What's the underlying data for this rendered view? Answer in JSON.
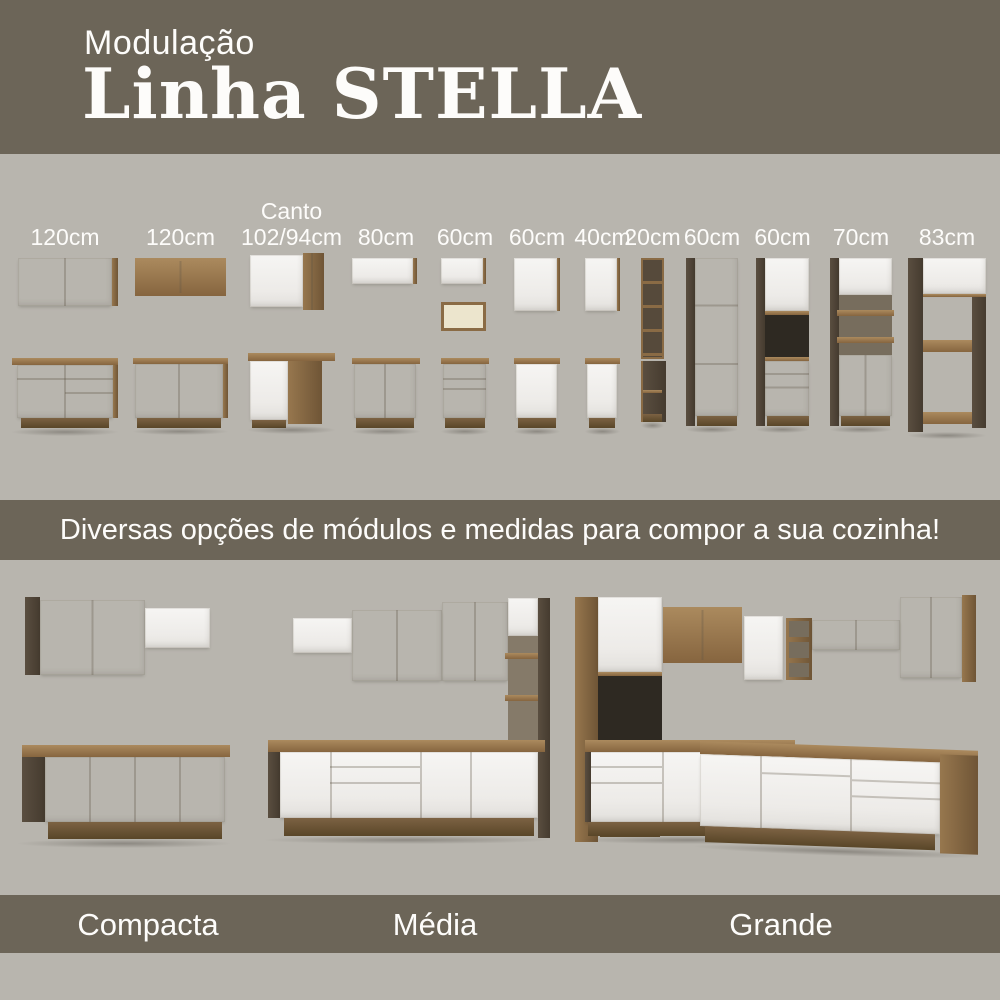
{
  "header": {
    "kicker": "Modulação",
    "title": "Linha STELLA"
  },
  "modules": {
    "items": [
      {
        "label": "120cm",
        "type": "wall-2door + base-drawers"
      },
      {
        "label": "120cm",
        "type": "wall-glass + base-2door"
      },
      {
        "label_top": "Canto",
        "label": "102/94cm",
        "type": "corner wall + corner base"
      },
      {
        "label": "80cm",
        "type": "wall-flap + base-2door"
      },
      {
        "label": "60cm",
        "type": "wall-flap + open-niche + base-drawers"
      },
      {
        "label": "60cm",
        "type": "wall-1door + base-1door"
      },
      {
        "label": "40cm",
        "type": "wall-1door + base-1door"
      },
      {
        "label": "20cm",
        "type": "open-shelf-rack + narrow-base"
      },
      {
        "label": "60cm",
        "type": "tall-pantry-3door"
      },
      {
        "label": "60cm",
        "type": "tall-oven-tower"
      },
      {
        "label": "70cm",
        "type": "tall-shelf-cabinet"
      },
      {
        "label": "83cm",
        "type": "tall-open-frame"
      }
    ]
  },
  "banner": {
    "text": "Diversas opções de módulos e medidas para compor a sua cozinha!"
  },
  "kitchens": {
    "items": [
      {
        "label": "Compacta"
      },
      {
        "label": "Média"
      },
      {
        "label": "Grande"
      }
    ]
  },
  "colors": {
    "band_olive": "#6c6558",
    "background_gray": "#b8b5ae",
    "cabinet_white": "#f2f1ef",
    "wood_medium": "#8f7048",
    "wood_dark": "#4d4336",
    "glass_amber": "#e4d193",
    "text": "#ffffff"
  }
}
